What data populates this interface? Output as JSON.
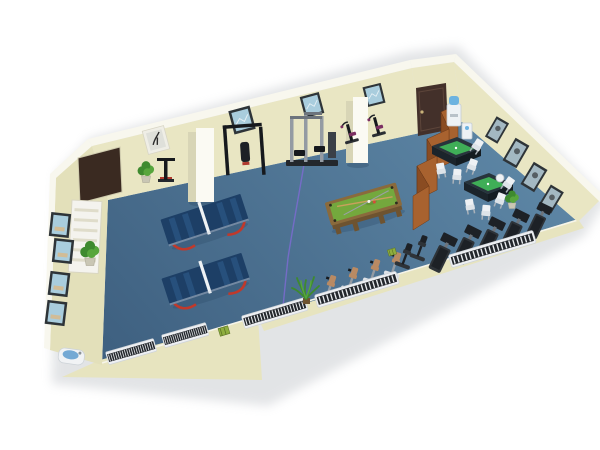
{
  "scene": {
    "title": "3D floor plan — community recreation and fitness room",
    "view": "isometric cutaway render on white background",
    "background": "#ffffff"
  },
  "labels": {
    "room": "Recreation room",
    "floor": "Blue floor",
    "back_wall": "Back wall",
    "left_wall": "Left wall",
    "right_wall": "Right wall",
    "front_wall": "Cutaway front wall",
    "door": "Door",
    "notice_board": "Notice board",
    "picture": "Framed picture",
    "shelf": "Slatted wall shelf",
    "pillar": "Pillar",
    "ping_pong_table": "Table tennis table",
    "pool_table": "Billiard table",
    "mahjong_table": "Mahjong table",
    "chair": "Chair",
    "stool": "Stool",
    "folding_screen": "Wooden folding screen",
    "water_cooler": "Water cooler",
    "dispenser": "Water dispenser",
    "multi_gym": "Multi-station gym machine",
    "power_rack": "Pull-up rack",
    "exercise_machine": "Exercise machine",
    "treadmill": "Treadmill",
    "exercise_bike": "Exercise bike",
    "radiator": "Radiator",
    "plant": "Potted plant",
    "palm": "Palm plant",
    "sink": "Drinking fountain",
    "cable": "Floor cable",
    "green_box": "Equipment box"
  },
  "inventory": {
    "ping_pong_tables": 2,
    "billiard_tables": 1,
    "mahjong_tables": 2,
    "treadmills": 5,
    "exercise_bikes": 6,
    "wall_pictures": 12,
    "radiators": 5,
    "plants": 4,
    "pillars": 2,
    "folding_screen_panels": 7
  },
  "colors": {
    "wall": "#e9e6c3",
    "wall_left": "#e3e0ba",
    "wall_front": "#e7e4bf",
    "wall_top": "#f8f7ee",
    "floor_light": "#5d86a5",
    "floor_dark": "#3f6181",
    "shadow": "#aeb3b9",
    "pingpong_top": "#1d3f66",
    "pingpong_stripe": "#27507c",
    "pingpong_leg": "#c0392b",
    "net": "#eef2f5",
    "pool_wood": "#8a6a3c",
    "pool_wood_dark": "#6e5330",
    "pool_felt": "#74a83d",
    "mahjong_frame": "#28343c",
    "mahjong_felt": "#3fae57",
    "screen_light": "#a8622f",
    "screen_dark": "#8a4c22",
    "door": "#43302a",
    "pillar_front": "#fbfaf3",
    "pillar_side": "#d8d5b6",
    "treadmill_dark": "#1d2126",
    "treadmill_mid": "#2e3338",
    "bike_seat": "#b98a63",
    "bike_base": "#dfe3e8",
    "machine_purple": "#7b2f62",
    "radiator_frame": "#eef0f3",
    "radiator_dark": "#23272c",
    "plant_dark": "#3e8a2f",
    "plant_light": "#57a63d",
    "frame_dark": "#2e3438",
    "frame_light": "#efeee6",
    "pic_blue": "#a9cddd",
    "pic_gray": "#a3b8c2",
    "cooler_blue": "#6db3e0",
    "appliance_white": "#eef2f5",
    "chair_white": "#eef1f4",
    "sink_blue": "#74a9d4",
    "cable": "#7b6bd0",
    "accent_red": "#b03a2e",
    "green_box": "#8fae3f",
    "board_brown": "#3a2a21"
  }
}
